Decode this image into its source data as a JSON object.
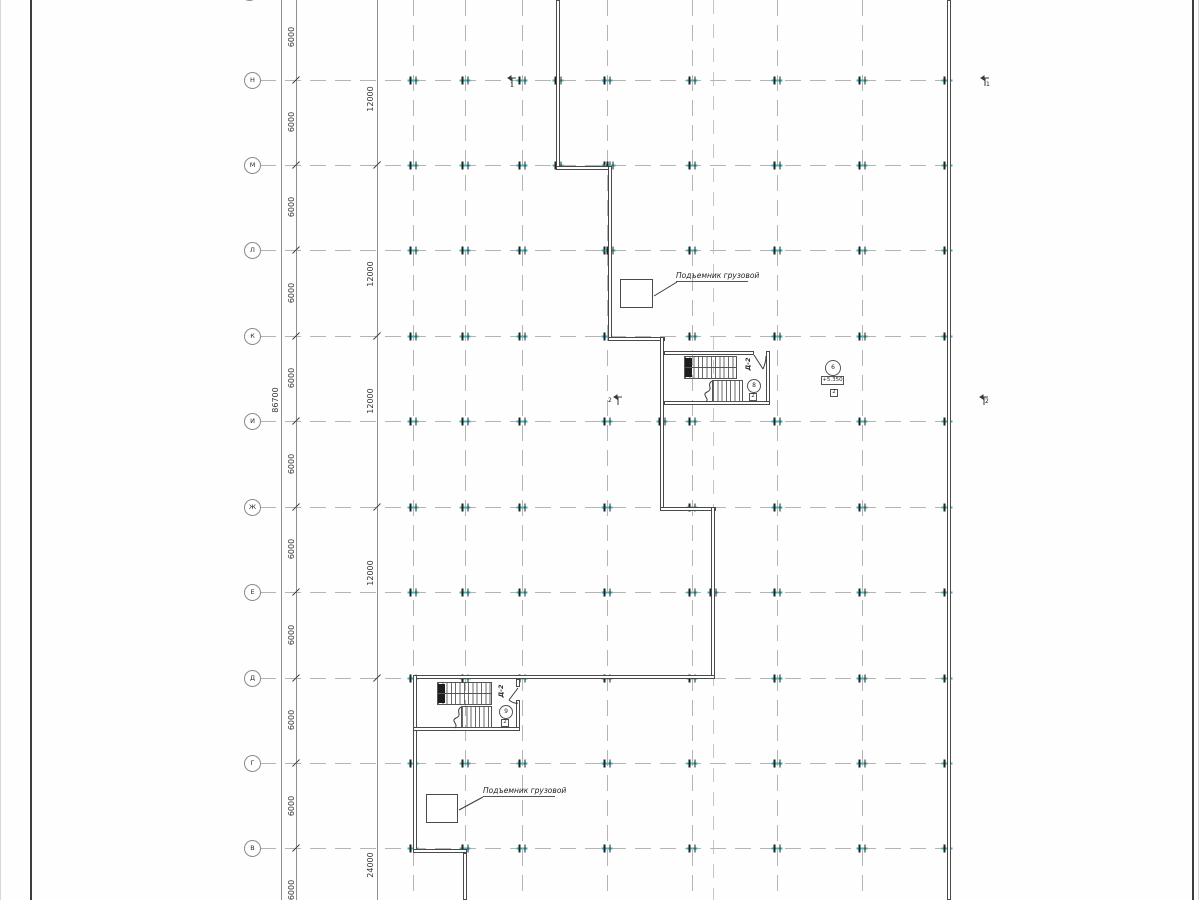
{
  "drawing": {
    "colors": {
      "wall": "#4a4a4a",
      "grid": "#b4b4b4",
      "dim": "#8f8f8f",
      "cyan_tick": "#3ab6bd",
      "text": "#2b2b2b",
      "frame": "#3d3d3d"
    },
    "grid": {
      "bubble_center_x": 252,
      "row_line_x1": 260,
      "row_line_x2": 948,
      "rows": [
        {
          "label": "Н",
          "y": 80
        },
        {
          "label": "М",
          "y": 165
        },
        {
          "label": "Л",
          "y": 250
        },
        {
          "label": "К",
          "y": 336
        },
        {
          "label": "И",
          "y": 421
        },
        {
          "label": "Ж",
          "y": 507
        },
        {
          "label": "Е",
          "y": 592
        },
        {
          "label": "Д",
          "y": 678
        },
        {
          "label": "Г",
          "y": 763
        },
        {
          "label": "В",
          "y": 848
        }
      ],
      "top_partial_bubble": {
        "x": 249,
        "y": -8
      },
      "columns": [
        413,
        465,
        522,
        607,
        692,
        777,
        862,
        947
      ],
      "aux_columns": [
        713
      ],
      "extra_ticks": [
        [
          558,
          80
        ],
        [
          558,
          165
        ],
        [
          610,
          165
        ],
        [
          610,
          250
        ],
        [
          662,
          421
        ],
        [
          713,
          592
        ]
      ]
    },
    "dimensions": {
      "total_line_x": 281,
      "total_label": {
        "text": "86700",
        "x": 276,
        "y": 400
      },
      "line1_x": 296,
      "line1_label_x": 292,
      "line1_labels": [
        {
          "text": "6000",
          "y": 37
        },
        {
          "text": "6000",
          "y": 122
        },
        {
          "text": "6000",
          "y": 207
        },
        {
          "text": "6000",
          "y": 293
        },
        {
          "text": "6000",
          "y": 378
        },
        {
          "text": "6000",
          "y": 464
        },
        {
          "text": "6000",
          "y": 549
        },
        {
          "text": "6000",
          "y": 635
        },
        {
          "text": "6000",
          "y": 720
        },
        {
          "text": "6000",
          "y": 806
        },
        {
          "text": "6000",
          "y": 890
        }
      ],
      "line2_x": 377,
      "line2_label_x": 371,
      "line2_ticks_y": [
        165,
        336,
        507,
        678
      ],
      "line2_labels": [
        {
          "text": "12000",
          "y": 99
        },
        {
          "text": "12000",
          "y": 274
        },
        {
          "text": "12000",
          "y": 401
        },
        {
          "text": "12000",
          "y": 573
        },
        {
          "text": "24000",
          "y": 865
        }
      ]
    },
    "walls": [
      [
        556,
        0,
        4,
        170
      ],
      [
        556,
        166,
        56,
        4
      ],
      [
        608,
        166,
        4,
        175
      ],
      [
        608,
        337,
        57,
        4
      ],
      [
        660,
        337,
        4,
        174
      ],
      [
        660,
        507,
        56,
        4
      ],
      [
        711,
        507,
        4,
        172
      ],
      [
        413,
        675,
        302,
        4
      ],
      [
        413,
        675,
        4,
        178
      ],
      [
        413,
        849,
        54,
        4
      ],
      [
        463,
        853,
        4,
        47
      ],
      [
        947,
        0,
        4,
        900
      ],
      [
        664,
        351,
        90,
        4
      ],
      [
        766,
        351,
        4,
        54
      ],
      [
        664,
        401,
        106,
        4
      ],
      [
        516,
        679,
        4,
        8
      ],
      [
        516,
        700,
        4,
        31
      ],
      [
        413,
        727,
        107,
        4
      ]
    ],
    "stairs": {
      "flights": [
        [
          684,
          356,
          53,
          23
        ],
        [
          712,
          380,
          31,
          22
        ],
        [
          437,
          682,
          55,
          23
        ],
        [
          461,
          706,
          31,
          22
        ]
      ],
      "dividers": [
        [
          684,
          367,
          53
        ],
        [
          437,
          693,
          55
        ]
      ],
      "blocks": [
        [
          685,
          358,
          7,
          9
        ],
        [
          685,
          368,
          7,
          9
        ],
        [
          438,
          684,
          7,
          9
        ],
        [
          438,
          694,
          7,
          9
        ]
      ]
    },
    "elevators": {
      "shafts": [
        [
          620,
          279,
          33,
          29
        ],
        [
          426,
          794,
          32,
          29
        ]
      ],
      "labels": [
        {
          "text": "Подъемник грузовой",
          "x": 676,
          "y": 271,
          "ul_x": 676,
          "ul_y": 281,
          "ul_w": 72
        },
        {
          "text": "Подъемник грузовой",
          "x": 483,
          "y": 786,
          "ul_x": 483,
          "ul_y": 796,
          "ul_w": 72
        }
      ]
    },
    "markers": {
      "circles": [
        {
          "text": "6",
          "cx": 832,
          "cy": 367,
          "d": 14
        },
        {
          "text": "8",
          "cx": 753,
          "cy": 385,
          "d": 12
        },
        {
          "text": "9",
          "cx": 505,
          "cy": 711,
          "d": 12
        }
      ],
      "squares": [
        {
          "text": "2",
          "x": 830,
          "y": 389
        },
        {
          "text": "2",
          "x": 749,
          "y": 393
        },
        {
          "text": "2",
          "x": 501,
          "y": 719
        }
      ],
      "elevation": {
        "text": "+5.350",
        "x": 821,
        "y": 376,
        "w": 23,
        "h": 9
      },
      "door_labels": [
        {
          "text": "Д-2",
          "cx": 748,
          "cy": 364
        },
        {
          "text": "Д-2",
          "cx": 501,
          "cy": 691
        }
      ]
    },
    "section_marks": [
      {
        "num": "1",
        "nx": 510,
        "ny": 83,
        "sym": [
          "M508,78 L516,78",
          "M512,78 L512,86",
          "M508,78 L511,76 L511,80 Z"
        ]
      },
      {
        "num": "1",
        "nx": 986,
        "ny": 82,
        "sym": [
          "M981,78 L989,78",
          "M985,78 L985,86",
          "M981,78 L984,76 L984,80 Z"
        ]
      },
      {
        "num": "2",
        "nx": 608,
        "ny": 398,
        "sym": [
          "M614,397 L622,397",
          "M618,397 L618,405",
          "M614,397 L617,395 L617,399 Z"
        ]
      },
      {
        "num": "2",
        "nx": 985,
        "ny": 399,
        "sym": [
          "M980,397 L988,397",
          "M984,397 L984,405",
          "M980,397 L983,395 L983,399 Z"
        ]
      }
    ],
    "svg_lines": [
      {
        "d": "M754,355 L763,369",
        "name": "door-leaf"
      },
      {
        "d": "M763,369 Q766,362 766,356",
        "name": "door-swing-arc"
      },
      {
        "d": "M518,688 L509,700",
        "name": "door-leaf"
      },
      {
        "d": "M509,700 Q514,704 518,703",
        "name": "door-swing-arc"
      },
      {
        "d": "M712,381 C706,385 714,389 707,392 C701,395 710,398 706,402",
        "name": "stair-break-line"
      },
      {
        "d": "M461,707 C455,711 463,715 456,718 C450,721 459,724 455,728",
        "name": "stair-break-line"
      },
      {
        "d": "M677,282 L654,296",
        "name": "leader-line"
      },
      {
        "d": "M483,797 L459,810",
        "name": "leader-line"
      }
    ]
  }
}
